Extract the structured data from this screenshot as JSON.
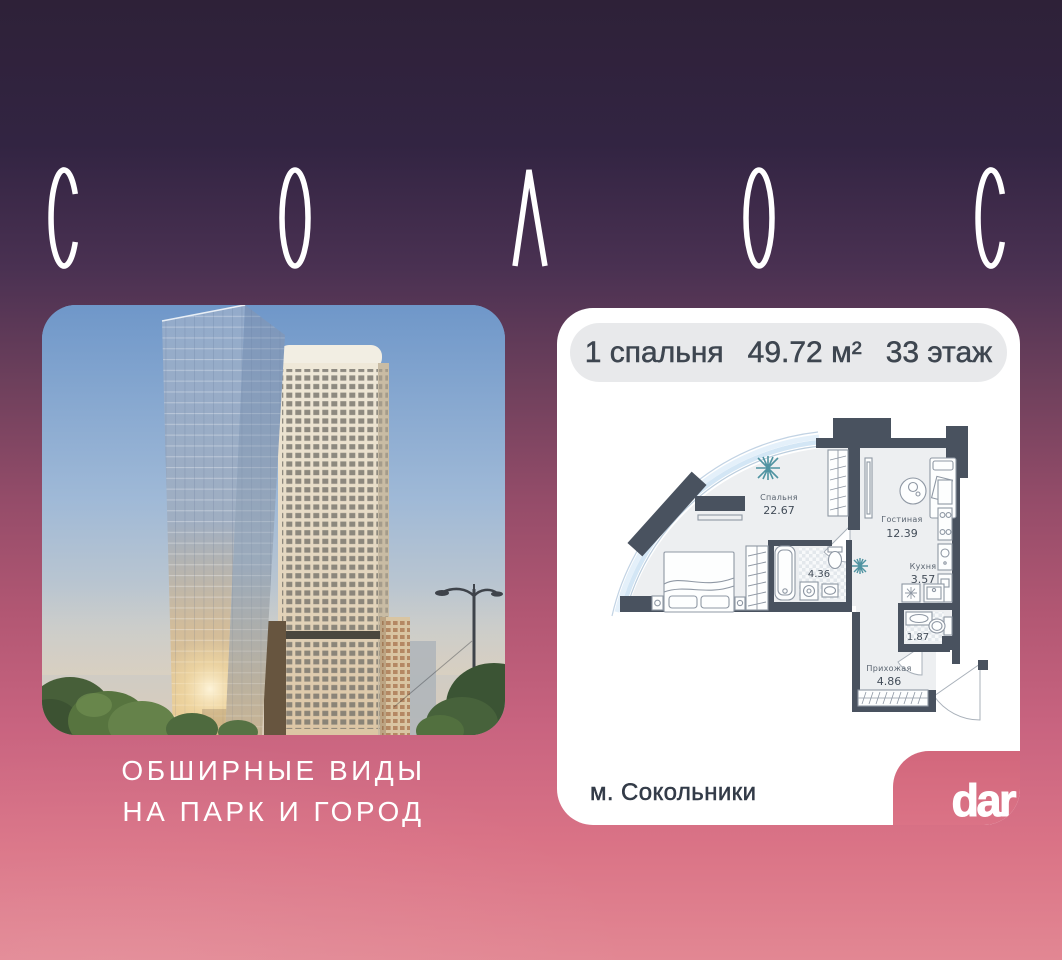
{
  "background": {
    "top_color": "#2E2138",
    "bottom_color": "#E28793"
  },
  "title": {
    "text": "СОЛОС"
  },
  "photo": {
    "caption_line1": "ОБШИРНЫЕ ВИДЫ",
    "caption_line2": "НА ПАРК И ГОРОД"
  },
  "card": {
    "header": {
      "bedrooms": "1 спальня",
      "area": "49.72 м²",
      "floor": "33 этаж"
    },
    "plan": {
      "bedroom": {
        "name": "Спальня",
        "area": "22.67"
      },
      "living": {
        "name": "Гостиная",
        "area": "12.39"
      },
      "kitchen": {
        "name": "Кухня",
        "area": "3.57"
      },
      "bathroom": {
        "area": "4.36"
      },
      "wc": {
        "area": "1.87"
      },
      "hallway": {
        "name": "Прихожая",
        "area": "4.86"
      }
    },
    "metro": "м. Сокольники",
    "logo": "dar"
  },
  "colors": {
    "plan_wall": "#49525F",
    "plan_plant_teal": "#4F93A1",
    "pill_bg": "#E8E9EB",
    "notch_top": "#D2677C",
    "notch_bottom": "#DB7386"
  }
}
